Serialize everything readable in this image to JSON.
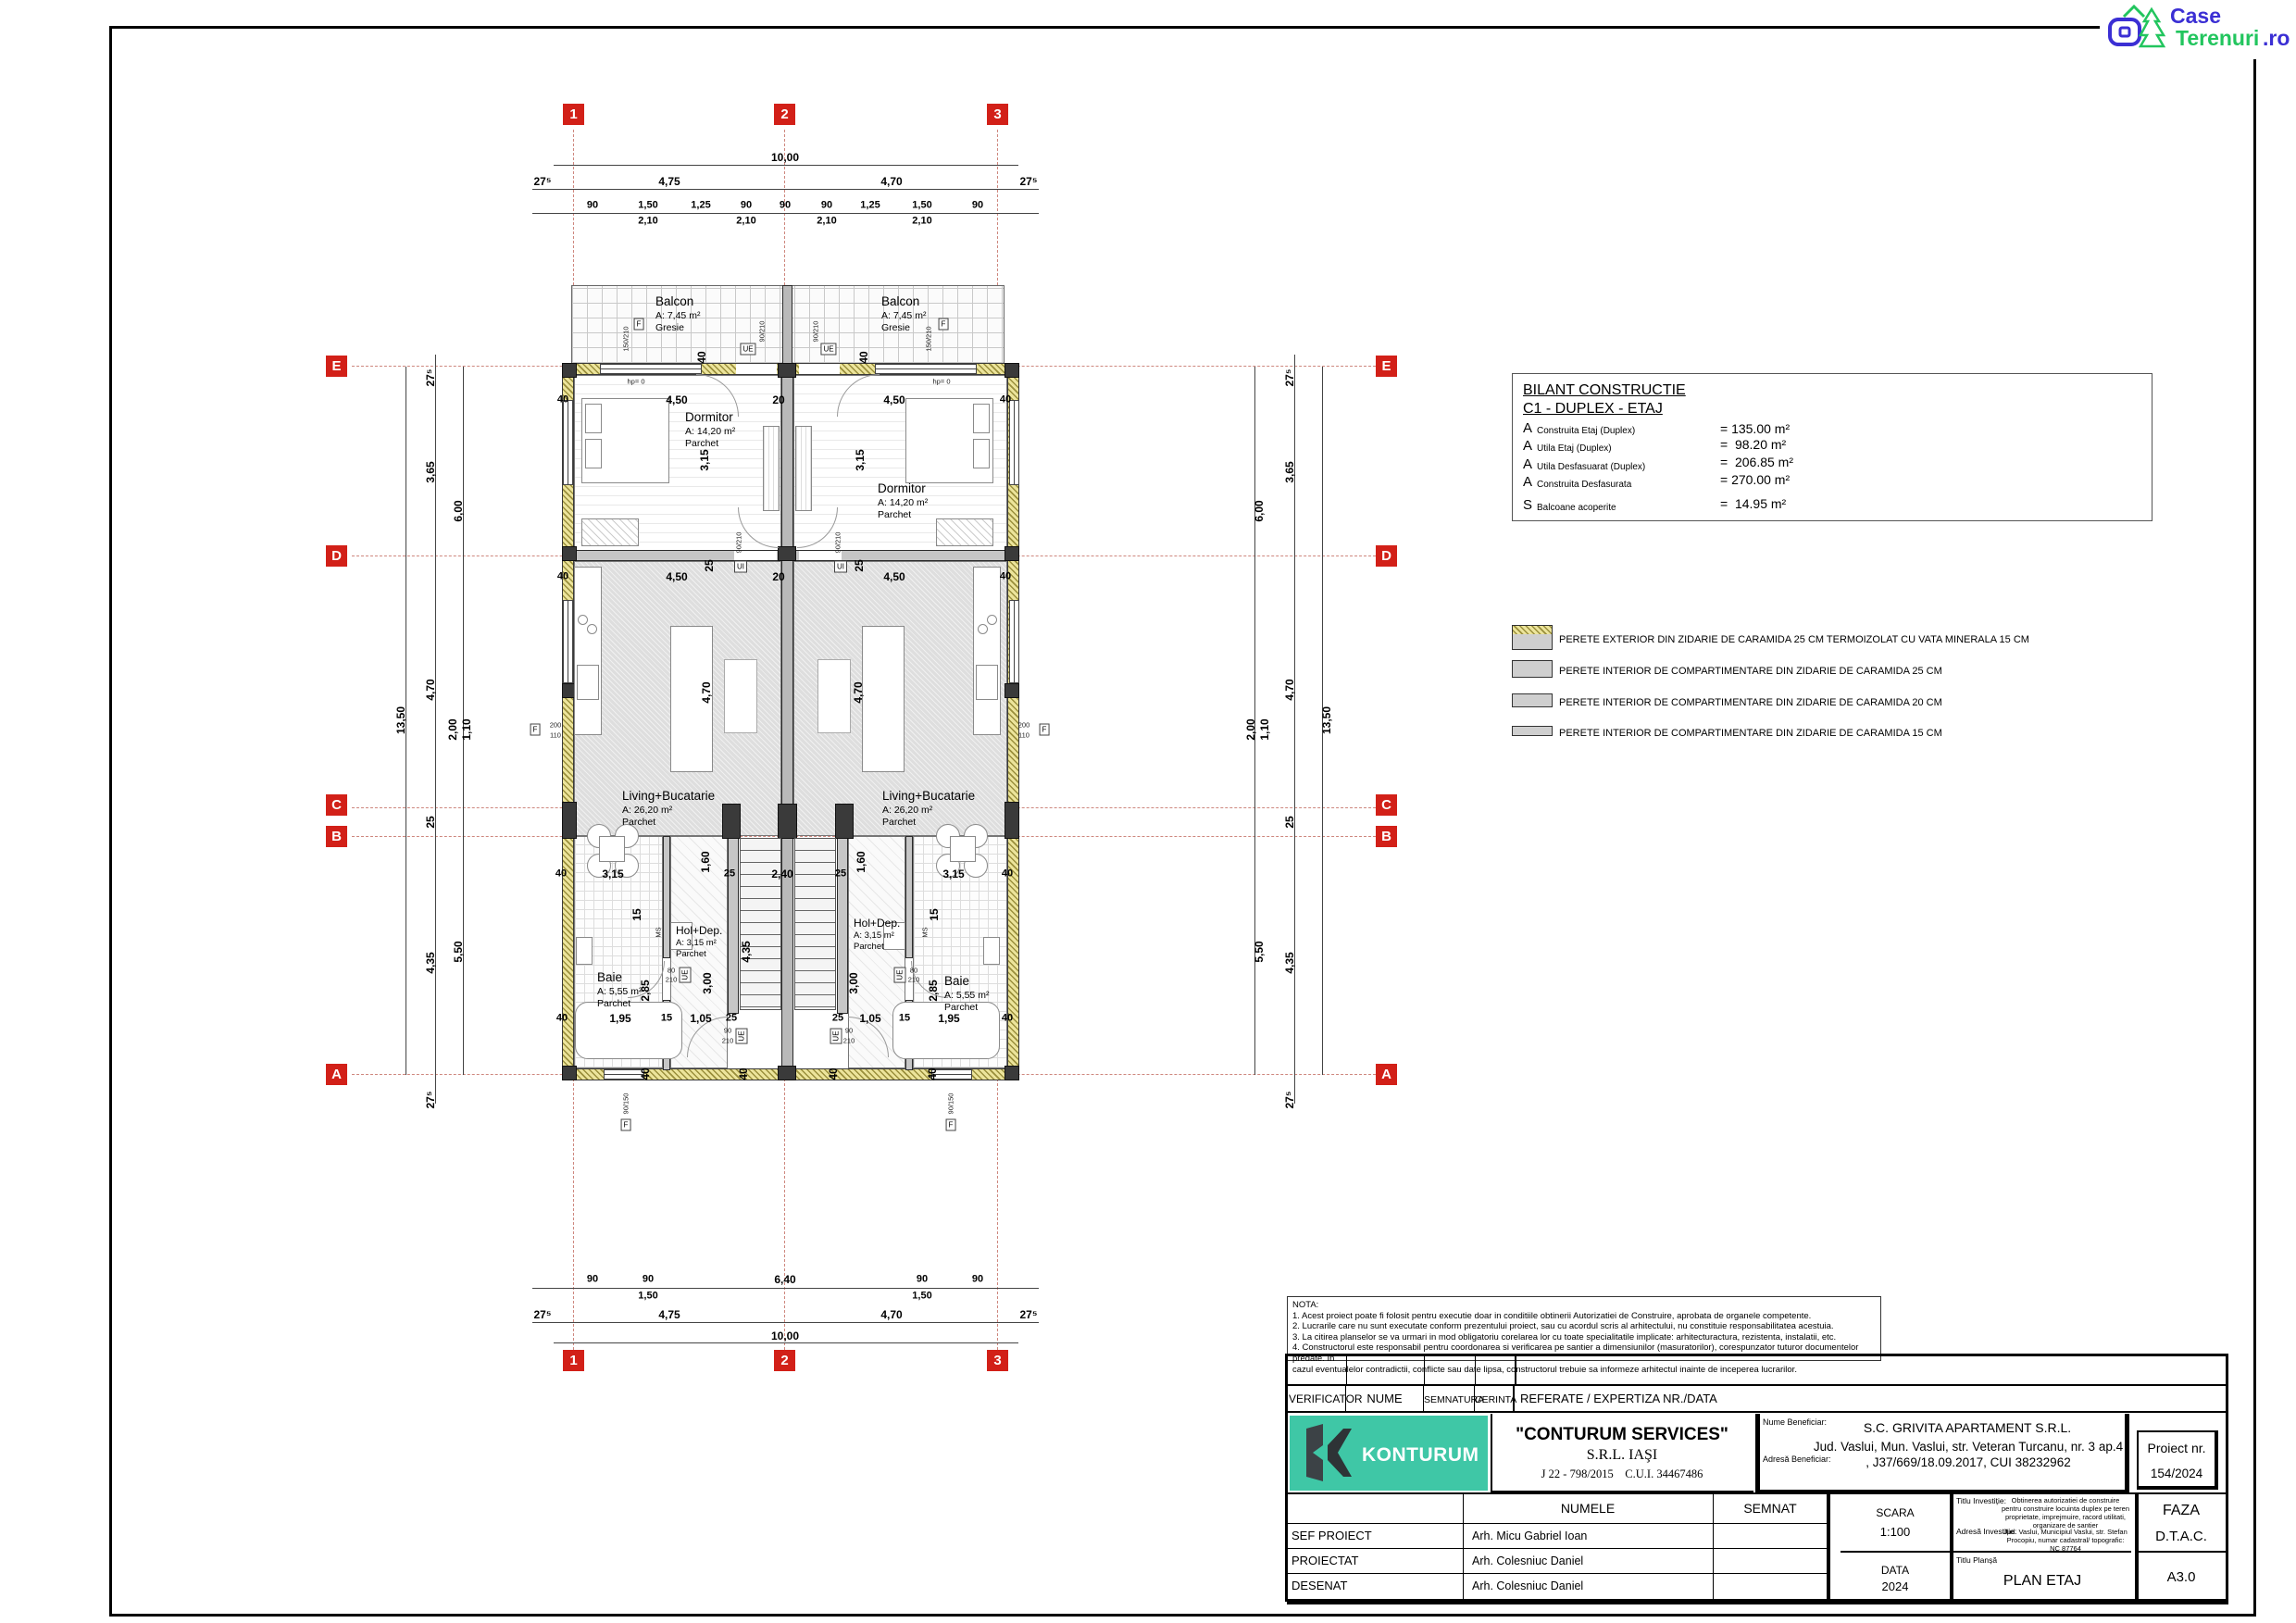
{
  "logo": {
    "case": "Case",
    "terenuri": "Terenuri",
    "ro": ".ro"
  },
  "axes": {
    "c1": "1",
    "c2": "2",
    "c3": "3",
    "rE": "E",
    "rD": "D",
    "rC": "C",
    "rB": "B",
    "rA": "A"
  },
  "dims": {
    "total": "10,00",
    "ax27": "27⁵",
    "ax475": "4,75",
    "ax470": "4,70",
    "f90": "90",
    "f150": "1,50",
    "f125": "1,25",
    "f210": "2,10",
    "f640": "6,40",
    "s1350": "13,50",
    "s365": "3,65",
    "s600": "6,00",
    "s470": "4,70",
    "s200": "2,00",
    "s110": "1,10",
    "s25": "25",
    "s435": "4,35",
    "s550": "5,50",
    "p40": "40",
    "p450": "4,50",
    "p20": "20",
    "p315": "3,15",
    "p240": "2,40",
    "p25": "25",
    "p195": "1,95",
    "p15": "15",
    "p105": "1,05",
    "p160": "1,60",
    "p300": "3,00",
    "p285": "2,85",
    "p435": "4,35"
  },
  "rooms": {
    "balcon": {
      "name": "Balcon",
      "area": "A: 7,45 m²",
      "floor": "Gresie"
    },
    "dormitor": {
      "name": "Dormitor",
      "area": "A: 14,20 m²",
      "floor": "Parchet"
    },
    "living": {
      "name": "Living+Bucatarie",
      "area": "A: 26,20 m²",
      "floor": "Parchet"
    },
    "hol": {
      "name": "Hol+Dep.",
      "area": "A: 3,15 m²",
      "floor": "Parchet"
    },
    "baie": {
      "name": "Baie",
      "area": "A: 5,55 m²",
      "floor": "Parchet"
    }
  },
  "tags": {
    "f": "F",
    "ue": "UE",
    "ui": "UI",
    "ms": "MS",
    "hp": "hp= 0",
    "t150_210": "150/210",
    "t90_210": "90/210",
    "t90_150": "90/150",
    "t80": "80",
    "t210": "210",
    "t90": "90",
    "t200": "200",
    "t110": "110"
  },
  "bilant": {
    "title": "BILANT CONSTRUCTIE",
    "subtitle": "C1 - DUPLEX - ETAJ",
    "rows": [
      {
        "sym": "A",
        "label": "Construita Etaj (Duplex)",
        "value": "= 135.00 m²"
      },
      {
        "sym": "A",
        "label": "Utila Etaj (Duplex)",
        "value": "=  98.20 m²"
      },
      {
        "sym": "A",
        "label": "Utila Desfasuarat (Duplex)",
        "value": "=  206.85 m²"
      },
      {
        "sym": "A",
        "label": "Construita Desfasurata",
        "value": "= 270.00 m²"
      },
      {
        "sym": "S",
        "label": "Balcoane acoperite",
        "value": "=  14.95 m²"
      }
    ]
  },
  "legend": {
    "items": [
      "PERETE EXTERIOR DIN ZIDARIE DE CARAMIDA 25 CM TERMOIZOLAT CU VATA MINERALA 15 CM",
      "PERETE INTERIOR DE COMPARTIMENTARE DIN ZIDARIE DE CARAMIDA  25 CM",
      "PERETE INTERIOR DE COMPARTIMENTARE DIN ZIDARIE DE CARAMIDA  20 CM",
      "PERETE INTERIOR DE COMPARTIMENTARE DIN ZIDARIE DE CARAMIDA  15 CM"
    ]
  },
  "nota": {
    "l0": "NOTA:",
    "l1": "1. Acest proiect poate fi folosit pentru executie doar in conditiile obtinerii Autorizatiei de Construire, aprobata de organele competente.",
    "l2": "2. Lucrarile care nu sunt executate conform prezentului proiect, sau cu acordul scris al arhitectului, nu constituie responsabilitatea  acestuia.",
    "l3": "3. La citirea planselor se va urmari in mod obligatoriu corelarea lor cu toate specialitatile implicate: arhitecturactura, rezistenta,  instalatii, etc.",
    "l4": "4. Constructorul este responsabil pentru coordonarea si verificarea pe santier a dimensiunilor (masuratorilor), corespunzator  tuturor documentelor predate. In",
    "l5": "cazul eventualelor contradictii, conflicte sau date lipsa, constructorul trebuie sa informeze  arhitectul inainte de inceperea lucrarilor."
  },
  "titleblock": {
    "header": {
      "verificator": "VERIFICATOR",
      "nume": "NUME",
      "semnatura": "SEMNATURA",
      "cerinta": "CERINTA",
      "referate": "REFERATE / EXPERTIZA NR./DATA"
    },
    "company": {
      "logo": "KONTURUM",
      "name": "\"CONTURUM SERVICES\"",
      "sub": "S.R.L. IAŞI",
      "reg": "J 22 - 798/2015    C.U.I. 34467486"
    },
    "beneficiar": {
      "label": "Nume Beneficiar:",
      "value": "S.C. GRIVITA APARTAMENT S.R.L.",
      "addr_label": "Adresă Beneficiar:",
      "addr_value": "Jud. Vaslui, Mun. Vaslui, str. Veteran Turcanu, nr. 3 ap.4 , J37/669/18.09.2017, CUI 38232962"
    },
    "proiect": {
      "label": "Proiect nr.",
      "value": "154/2024"
    },
    "staff": {
      "numele": "NUMELE",
      "semnat": "SEMNAT",
      "rows": [
        {
          "role": "SEF PROIECT",
          "name": "Arh. Micu Gabriel Ioan"
        },
        {
          "role": "PROIECTAT",
          "name": "Arh. Colesniuc Daniel"
        },
        {
          "role": "DESENAT",
          "name": "Arh. Colesniuc Daniel"
        }
      ]
    },
    "scara": {
      "label": "SCARA",
      "value": "1:100"
    },
    "data": {
      "label": "DATA",
      "value": "2024"
    },
    "investitie": {
      "label": "Titlu Investiție:",
      "value": "Obtinerea autorizatiei de construire pentru construire locuinta duplex pe teren proprietate, imprejmuire, racord utilitati, organizare de santier",
      "addr_label": "Adresă Investiție:",
      "addr_value": "Jud. Vaslui, Municipiul Vaslui, str. Stefan Procopiu, numar cadastral/ topografic: NC 87764"
    },
    "plansa": {
      "label": "Titlu Planșă",
      "value": "PLAN ETAJ"
    },
    "faza": {
      "label": "FAZA",
      "value": "D.T.A.C."
    },
    "sheet": "A3.0"
  }
}
